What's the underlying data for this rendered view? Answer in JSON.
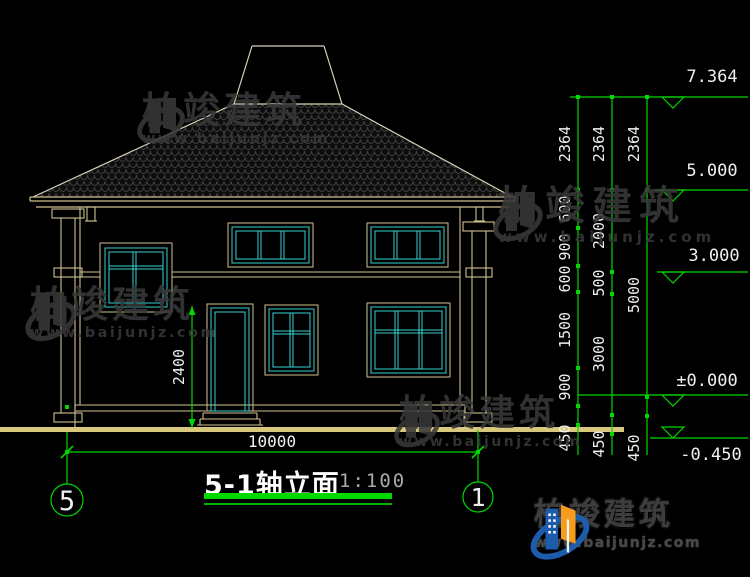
{
  "title": {
    "text": "5-1轴立面",
    "scale": "1:100"
  },
  "axis": {
    "left": "5",
    "right": "1"
  },
  "brand": {
    "name": "柏竣建筑",
    "site": "www.baijunjz.com"
  },
  "elevations": [
    "7.364",
    "5.000",
    "3.000",
    "±0.000",
    "-0.450"
  ],
  "dims": {
    "total_width": "10000",
    "door_height": "2400",
    "chain1": [
      "2364",
      "600",
      "900",
      "600",
      "1500",
      "900",
      "450"
    ],
    "chain2": [
      "2364",
      "2000",
      "500",
      "3000",
      "450"
    ],
    "chain3": [
      "2364",
      "5000",
      "450"
    ]
  },
  "colors": {
    "dim_green": "#00d800",
    "line_tan": "#cfc08e",
    "window_cyan": "#38d1d1",
    "ground_khaki": "#d8c87e",
    "watermark_gray": "#383838",
    "logo_blue": "#1d5cab",
    "logo_orange": "#f59b1e"
  }
}
